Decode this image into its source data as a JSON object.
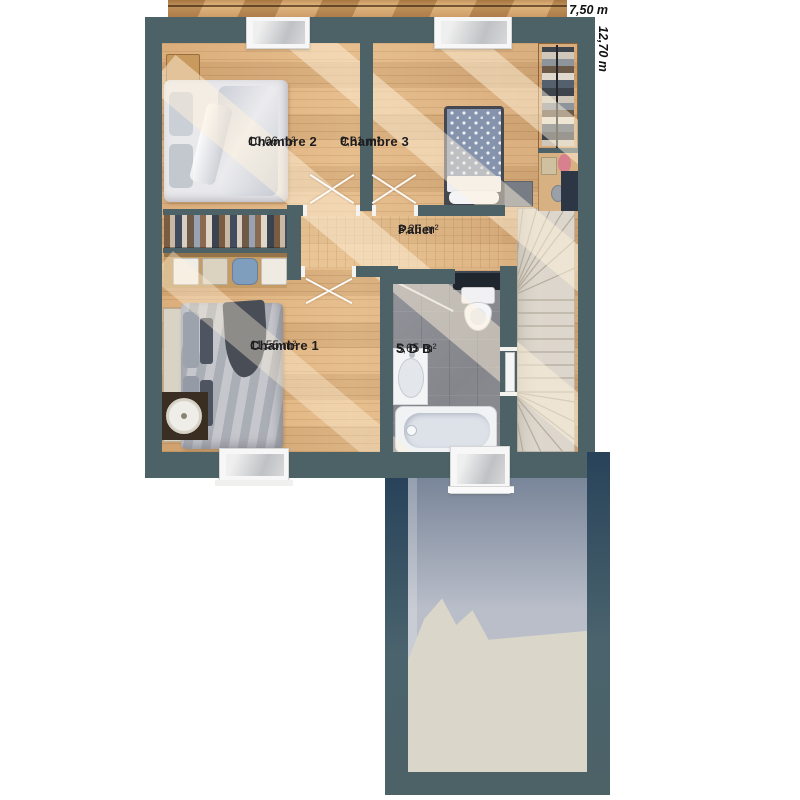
{
  "plan": {
    "type": "floor-plan-etage",
    "dimensions": {
      "width": "7,50 m",
      "depth": "12,70 m"
    },
    "rooms": [
      {
        "name": "Chambre 2",
        "area": "10,06 m²"
      },
      {
        "name": "Chambre 3",
        "area": "9,31 m²"
      },
      {
        "name": "Palier",
        "area": "3,26 m²"
      },
      {
        "name": "Chambre 1",
        "area": "11,55 m²"
      },
      {
        "name": "S D B",
        "area": "5,65 m²"
      }
    ],
    "colors": {
      "wall": "#4d6267",
      "floor": "#ddb07e",
      "tile": "#8b8c91",
      "stair": "#dcd6cc",
      "garage_slab": "#b9bec9",
      "garage_slab_light": "#dad6ca"
    }
  }
}
